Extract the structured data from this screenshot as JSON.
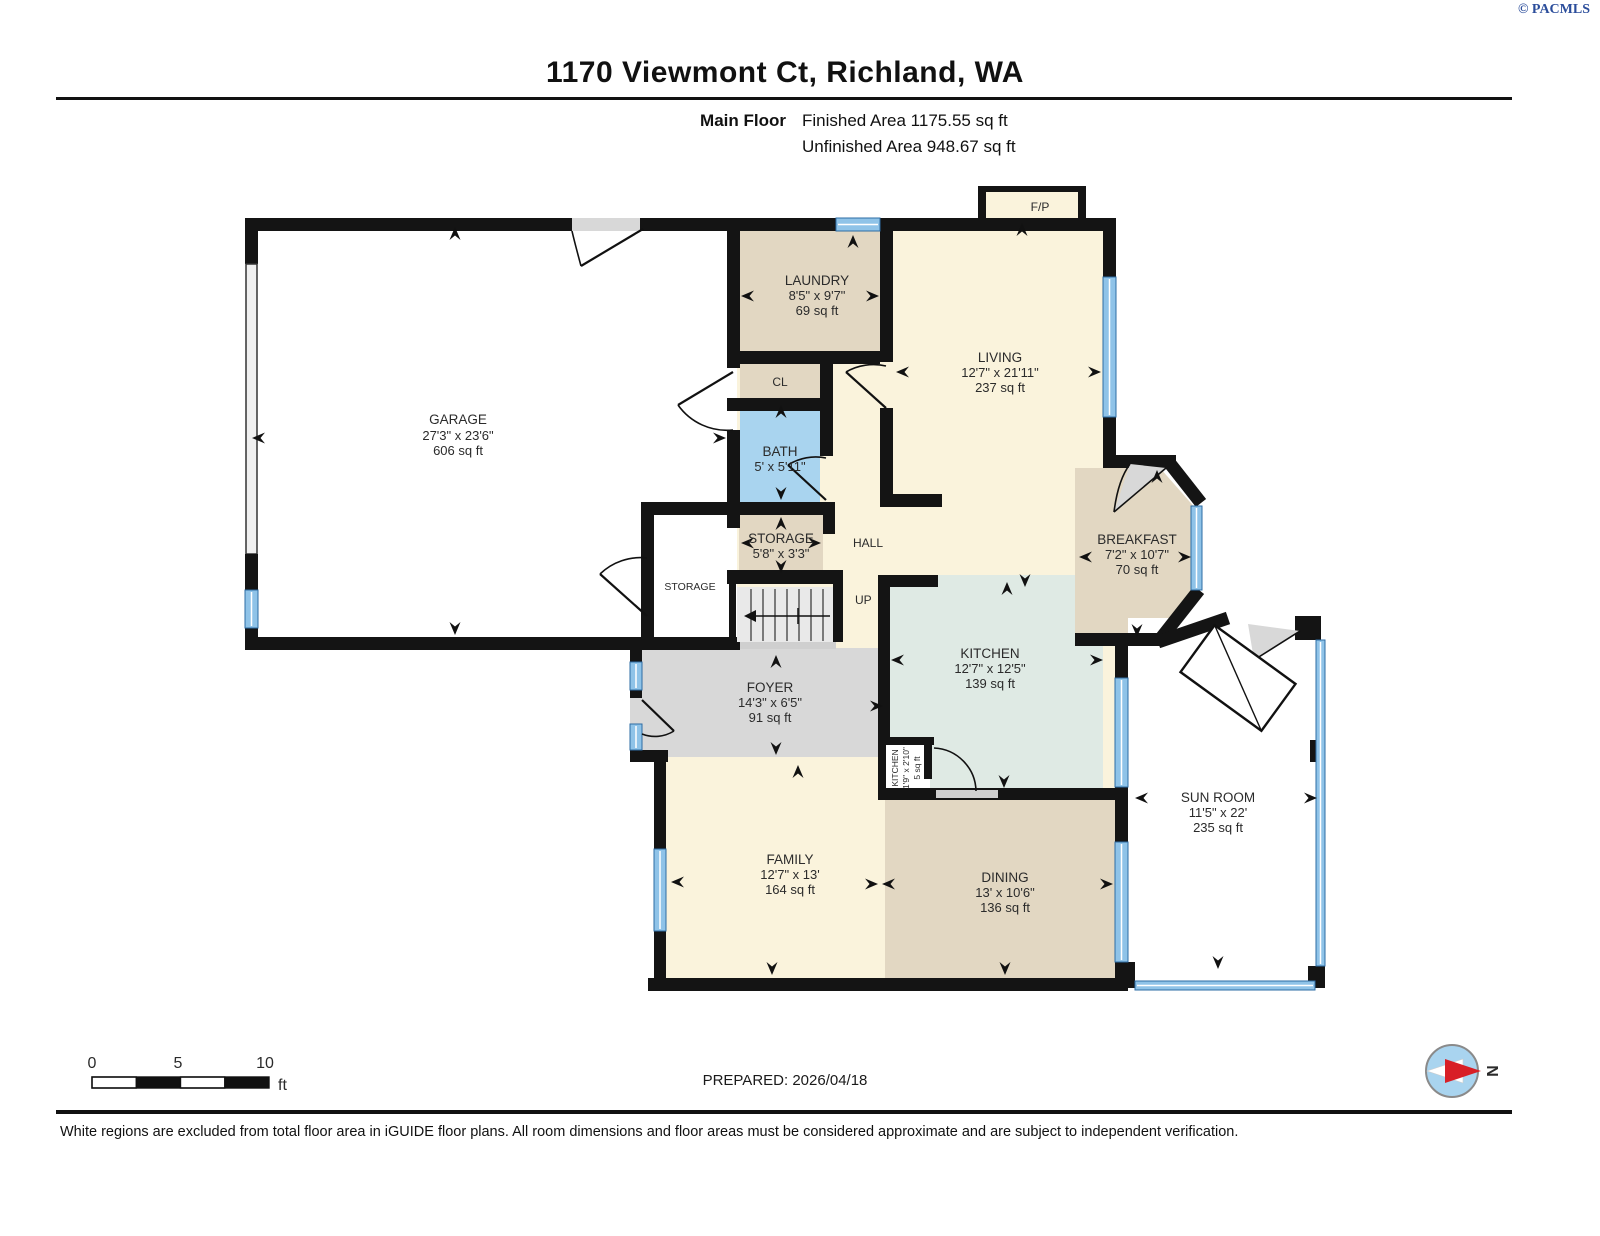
{
  "watermark": "© PACMLS",
  "header": {
    "title": "1170 Viewmont Ct, Richland, WA",
    "floor_label": "Main Floor",
    "finished": "Finished Area 1175.55 sq ft",
    "unfinished": "Unfinished Area 948.67 sq ft"
  },
  "rooms": {
    "garage": {
      "name": "GARAGE",
      "dims": "27'3\" x 23'6\"",
      "area": "606 sq ft"
    },
    "laundry": {
      "name": "LAUNDRY",
      "dims": "8'5\" x 9'7\"",
      "area": "69 sq ft"
    },
    "living": {
      "name": "LIVING",
      "dims": "12'7\" x 21'11\"",
      "area": "237 sq ft"
    },
    "fireplace": {
      "name": "F/P"
    },
    "closet": {
      "name": "CL"
    },
    "bath": {
      "name": "BATH",
      "dims": "5' x 5'11\""
    },
    "storage": {
      "name": "STORAGE",
      "dims": "5'8\" x 3'3\""
    },
    "storage2": {
      "name": "STORAGE"
    },
    "hall": {
      "name": "HALL"
    },
    "stairs": {
      "name": "UP"
    },
    "foyer": {
      "name": "FOYER",
      "dims": "14'3\" x 6'5\"",
      "area": "91 sq ft"
    },
    "kitchen": {
      "name": "KITCHEN",
      "dims": "12'7\" x 12'5\"",
      "area": "139 sq ft"
    },
    "pantry": {
      "name": "KITCHEN",
      "dims": "1'9\" x 2'10\"",
      "area": "5 sq ft"
    },
    "breakfast": {
      "name": "BREAKFAST",
      "dims": "7'2\" x 10'7\"",
      "area": "70 sq ft"
    },
    "sunroom": {
      "name": "SUN ROOM",
      "dims": "11'5\" x 22'",
      "area": "235 sq ft"
    },
    "family": {
      "name": "FAMILY",
      "dims": "12'7\" x 13'",
      "area": "164 sq ft"
    },
    "dining": {
      "name": "DINING",
      "dims": "13' x 10'6\"",
      "area": "136 sq ft"
    }
  },
  "footer": {
    "scale": {
      "tick0": "0",
      "tick5": "5",
      "tick10": "10",
      "unit": "ft"
    },
    "prepared": "PREPARED: 2026/04/18",
    "compass": "N",
    "disclaimer": "White regions are excluded from total floor area in iGUIDE floor plans. All room dimensions and floor areas must be considered approximate and are subject to independent verification."
  },
  "colors": {
    "wall": "#141414",
    "cream": "#faf3dc",
    "tan": "#e2d7c2",
    "mint": "#dfeae4",
    "bath_blue": "#a9d4ef",
    "gray": "#d8d8d8",
    "window": "#8fc3e8",
    "glass": "#5b9bd5"
  }
}
